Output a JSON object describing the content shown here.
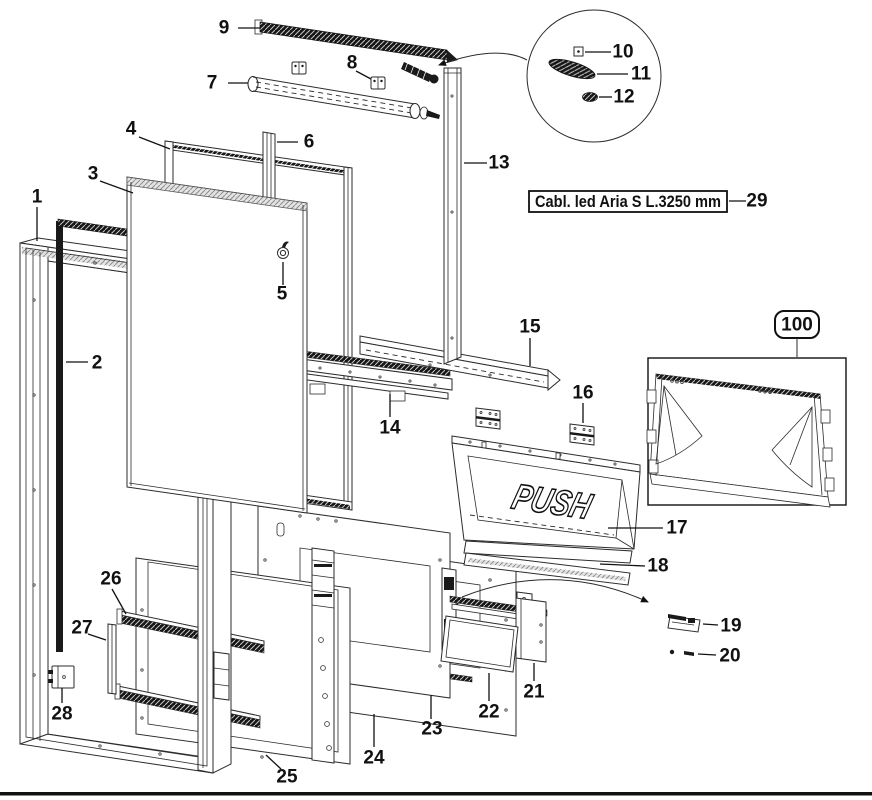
{
  "diagram": {
    "title_hint": "exploded door assembly parts diagram",
    "push_panel": {
      "text": "PUSH"
    },
    "label_box_29": {
      "text": "Cabl. led Aria S L.3250 mm"
    },
    "inset_label_100": {
      "text": "100"
    },
    "callouts": [
      {
        "number": "1",
        "x": 37,
        "y": 197,
        "leader": "37,207 37,241"
      },
      {
        "number": "2",
        "x": 97,
        "y": 363,
        "leader": "66,362 88,362"
      },
      {
        "number": "3",
        "x": 93,
        "y": 174,
        "leader": "100,181 133,193"
      },
      {
        "number": "4",
        "x": 131,
        "y": 129,
        "leader": "139,137 170,149"
      },
      {
        "number": "5",
        "x": 282,
        "y": 294,
        "leader": "283,262 283,285"
      },
      {
        "number": "6",
        "x": 309,
        "y": 142,
        "leader": "277,142 298,142"
      },
      {
        "number": "7",
        "x": 212,
        "y": 83,
        "leader": "228,83 248,83"
      },
      {
        "number": "8",
        "x": 352,
        "y": 63,
        "leader": "356,71 371,79"
      },
      {
        "number": "9",
        "x": 224,
        "y": 28,
        "leader": "238,28 260,28"
      },
      {
        "number": "10",
        "x": 623,
        "y": 52,
        "leader": "585,52 611,52"
      },
      {
        "number": "11",
        "x": 641,
        "y": 74,
        "leader": "597,74 628,74"
      },
      {
        "number": "12",
        "x": 624,
        "y": 97,
        "leader": "599,97 612,97"
      },
      {
        "number": "13",
        "x": 499,
        "y": 163,
        "leader": "464,163 487,163"
      },
      {
        "number": "14",
        "x": 390,
        "y": 428,
        "leader": "390,394 390,417"
      },
      {
        "number": "15",
        "x": 530,
        "y": 327,
        "leader": "530,338 530,366"
      },
      {
        "number": "16",
        "x": 583,
        "y": 393,
        "leader": "583,403 583,423"
      },
      {
        "number": "17",
        "x": 677,
        "y": 528,
        "leader": "608,528 663,528"
      },
      {
        "number": "18",
        "x": 658,
        "y": 566,
        "leader": "600,564 645,566"
      },
      {
        "number": "19",
        "x": 731,
        "y": 626,
        "leader": "703,624 718,625"
      },
      {
        "number": "20",
        "x": 730,
        "y": 656,
        "leader": "698,654 716,655"
      },
      {
        "number": "21",
        "x": 534,
        "y": 692,
        "leader": "534,663 534,681"
      },
      {
        "number": "22",
        "x": 489,
        "y": 712,
        "leader": "489,673 489,701"
      },
      {
        "number": "23",
        "x": 432,
        "y": 729,
        "leader": "431,695 431,719"
      },
      {
        "number": "24",
        "x": 374,
        "y": 758,
        "leader": "374,714 374,747"
      },
      {
        "number": "25",
        "x": 287,
        "y": 777,
        "leader": "266,755 281,769"
      },
      {
        "number": "26",
        "x": 111,
        "y": 579,
        "leader": "112,589 126,614"
      },
      {
        "number": "27",
        "x": 82,
        "y": 628,
        "leader": "88,634 106,640"
      },
      {
        "number": "28",
        "x": 62,
        "y": 714,
        "leader": "62,688 62,703"
      },
      {
        "number": "29",
        "x": 757,
        "y": 201,
        "leader": "729,201 746,201"
      }
    ]
  },
  "colors": {
    "line": "#2b2b2b",
    "dark": "#1a1a1a",
    "background": "#ffffff",
    "gasket": "#111111"
  }
}
